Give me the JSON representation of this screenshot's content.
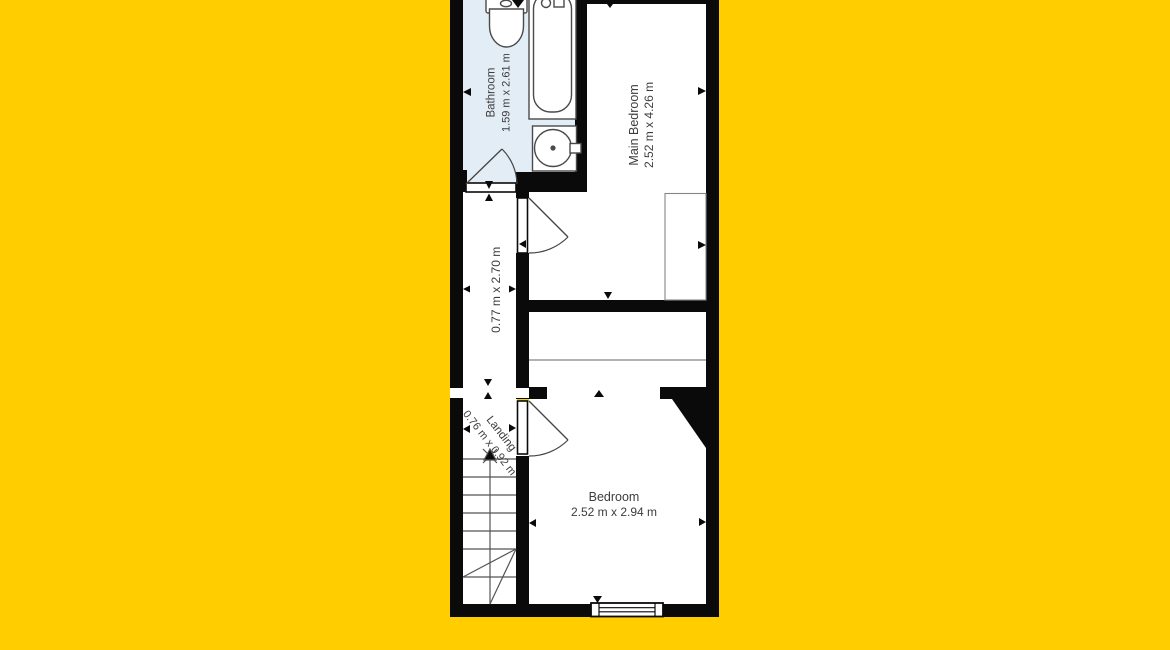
{
  "colors": {
    "background": "#FFCD00",
    "wall": "#0a0a0a",
    "bathroom-fill": "#E3EDF6",
    "room-fill": "#FFFFFF",
    "label-text": "#3C3C3C",
    "fixture-stroke": "#4A4A4A"
  },
  "floor_plan": {
    "rooms": [
      {
        "name": "Bathroom",
        "dimensions": "1.59 m x 2.61 m"
      },
      {
        "name": "Main Bedroom",
        "dimensions": "2.52 m x 4.26 m"
      },
      {
        "name": "",
        "dimensions": "0.77 m x 2.70 m"
      },
      {
        "name": "Landing",
        "dimensions": "0.76 m x 0.92 m"
      },
      {
        "name": "Bedroom",
        "dimensions": "2.52 m x 2.94 m"
      }
    ],
    "fixtures": [
      "toilet",
      "bathtub",
      "sink",
      "wardrobe",
      "staircase",
      "window",
      "door"
    ]
  }
}
